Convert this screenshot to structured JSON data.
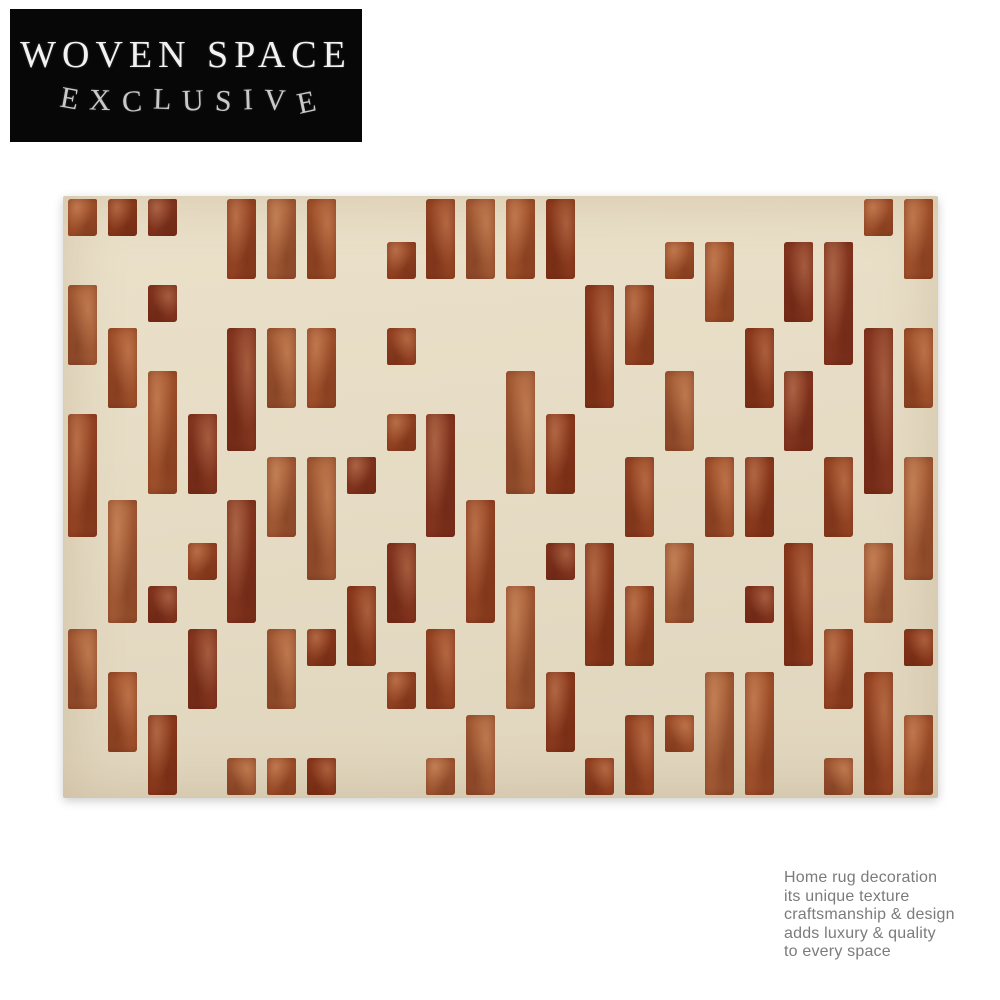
{
  "brand": {
    "line1": "WOVEN SPACE",
    "line2": "EXCLUSIVE",
    "bg_color": "#070707",
    "line1_color": "#f2f2f2",
    "line2_color": "#c9c9c9"
  },
  "caption": {
    "color": "#7b7b7b",
    "lines": [
      "Home rug decoration",
      "its unique texture",
      "craftsmanship & design",
      "adds luxury & quality",
      "to every space"
    ]
  },
  "rug": {
    "background_color": "#e7ddc6",
    "background_gradient_top": "#ebe1ca",
    "background_gradient_bottom": "#e0d5bd",
    "bar_palette": [
      "#8f3d1f",
      "#9a4826",
      "#a5552e",
      "#873821",
      "#a85f38"
    ],
    "grid": {
      "cols": 22,
      "rows": 14,
      "filled": [
        [
          0,
          1,
          2,
          4,
          5,
          6,
          9,
          10,
          11,
          12,
          20,
          21
        ],
        [
          4,
          5,
          6,
          8,
          9,
          10,
          11,
          12,
          15,
          16,
          18,
          19,
          21
        ],
        [
          0,
          2,
          13,
          14,
          16,
          18,
          19
        ],
        [
          0,
          1,
          4,
          5,
          6,
          8,
          13,
          14,
          17,
          19,
          20,
          21
        ],
        [
          1,
          2,
          4,
          5,
          6,
          11,
          13,
          15,
          17,
          18,
          20,
          21
        ],
        [
          0,
          2,
          3,
          4,
          8,
          9,
          11,
          12,
          15,
          18,
          20
        ],
        [
          0,
          2,
          3,
          5,
          6,
          7,
          9,
          11,
          12,
          14,
          16,
          17,
          19,
          20,
          21
        ],
        [
          0,
          1,
          4,
          5,
          6,
          9,
          10,
          14,
          16,
          17,
          19,
          21
        ],
        [
          1,
          3,
          4,
          6,
          8,
          10,
          12,
          13,
          15,
          18,
          20,
          21
        ],
        [
          1,
          2,
          4,
          7,
          8,
          10,
          11,
          13,
          14,
          15,
          17,
          18,
          20
        ],
        [
          0,
          3,
          5,
          6,
          7,
          9,
          11,
          13,
          14,
          18,
          19,
          21
        ],
        [
          0,
          1,
          3,
          5,
          8,
          9,
          11,
          12,
          16,
          17,
          19,
          20
        ],
        [
          1,
          2,
          10,
          12,
          14,
          15,
          16,
          17,
          20,
          21
        ],
        [
          2,
          4,
          5,
          6,
          9,
          10,
          13,
          14,
          16,
          17,
          19,
          20,
          21
        ]
      ]
    }
  }
}
